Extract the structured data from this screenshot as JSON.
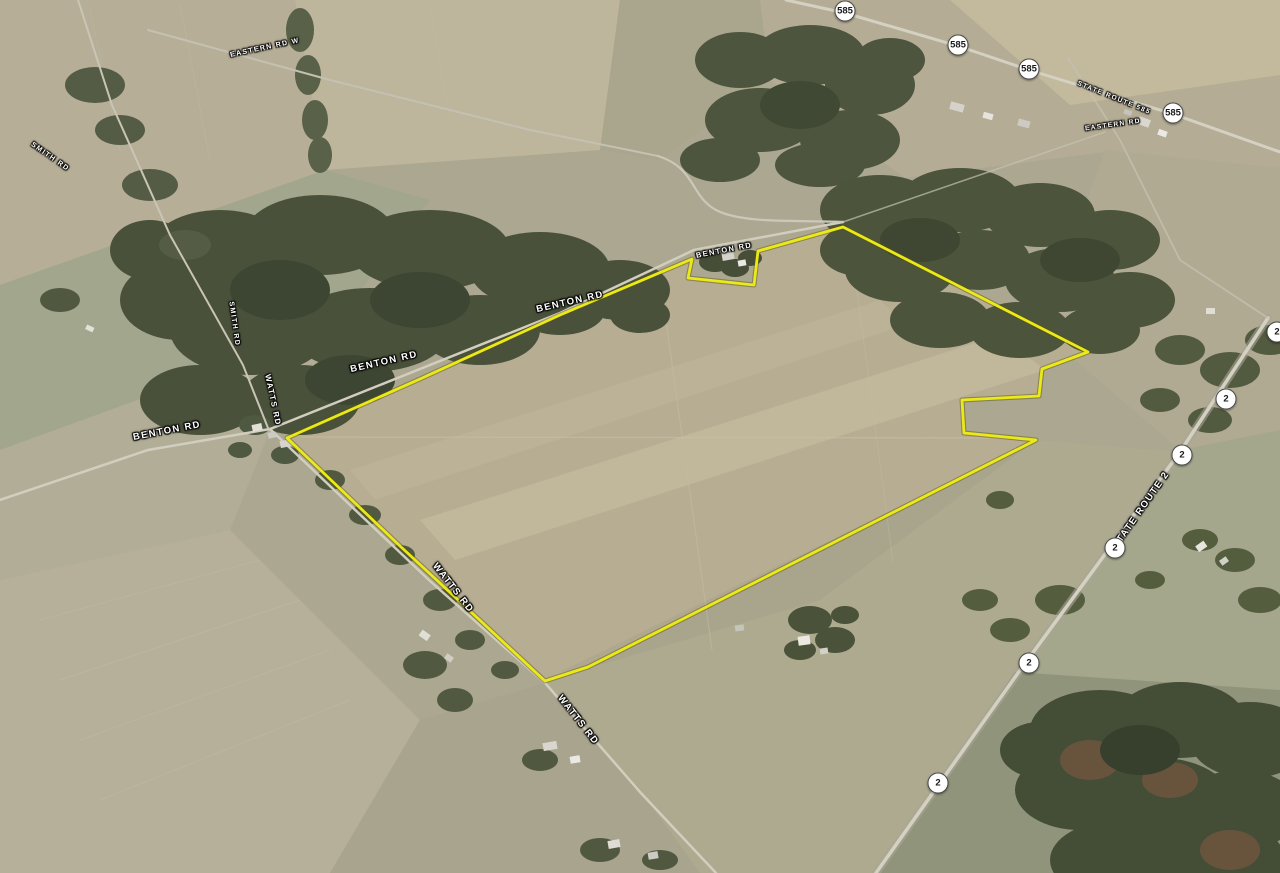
{
  "meta": {
    "view": "oblique-aerial-satellite",
    "description": "Google-Earth style aerial view of farmland parcel outlined in yellow",
    "width": 1280,
    "height": 873
  },
  "colors": {
    "boundary": "#f2ee0e",
    "label_text": "#ffffff",
    "shield_background": "#ffffff",
    "shield_text": "#1a1a1a"
  },
  "boundary": {
    "points": "287,438 420,379 560,315 692,259 688,278 754,285 758,251 843,227 1088,352 1042,369 1039,396 962,400 964,433 1036,440 588,667 545,681 470,611 400,546"
  },
  "road_labels": [
    {
      "text": "EASTERN RD W"
    },
    {
      "text": "SMITH RD"
    },
    {
      "text": "SMITH RD"
    },
    {
      "text": "BENTON RD"
    },
    {
      "text": "BENTON RD"
    },
    {
      "text": "BENTON RD"
    },
    {
      "text": "BENTON RD"
    },
    {
      "text": "WATTS RD"
    },
    {
      "text": "WATTS RD"
    },
    {
      "text": "WATTS RD"
    },
    {
      "text": "STATE ROUTE 2"
    },
    {
      "text": "STATE ROUTE 585"
    },
    {
      "text": "EASTERN RD"
    }
  ],
  "route_shields": [
    {
      "label": "585"
    },
    {
      "label": "585"
    },
    {
      "label": "585"
    },
    {
      "label": "585"
    },
    {
      "label": "2"
    },
    {
      "label": "2"
    },
    {
      "label": "2"
    },
    {
      "label": "2"
    },
    {
      "label": "2"
    },
    {
      "label": "2"
    }
  ]
}
